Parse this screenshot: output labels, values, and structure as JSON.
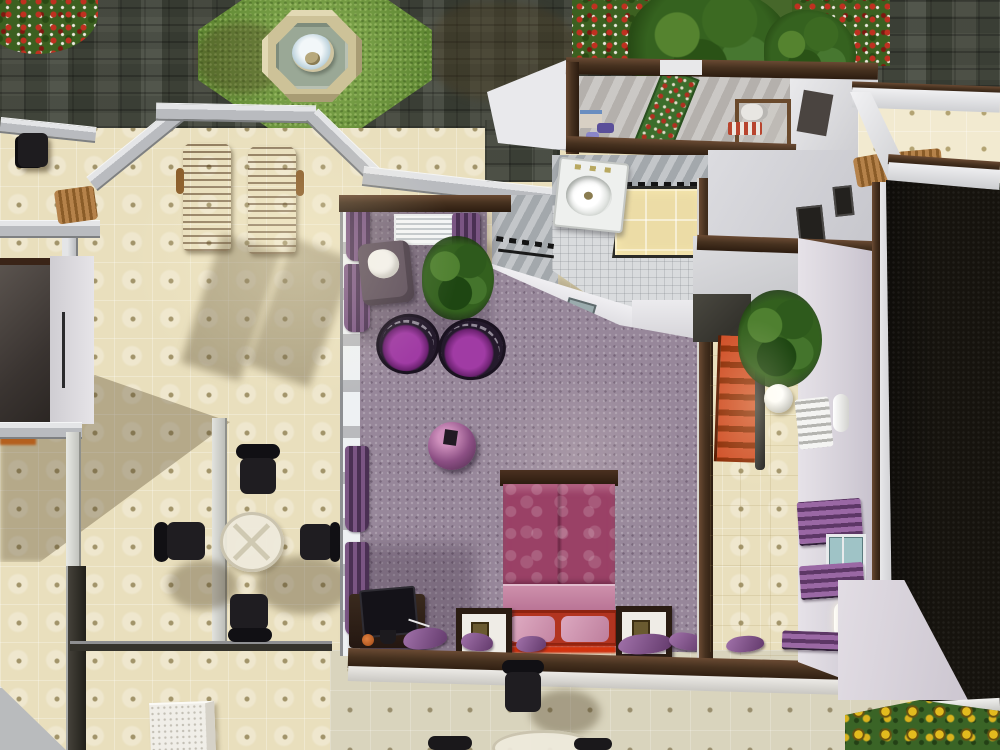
{
  "meta": {
    "domain": "Game",
    "description": "Top-down cutaway view of a residential lot in a life-simulation game. No HUD or text is visible; pure in-world overhead camera of a house interior and courtyard."
  },
  "colors": {
    "tileCream": "#e9dfbd",
    "tileGreyCream": "#d9d4bd",
    "tileDot": "#a2946a",
    "cobble1": "#85887f",
    "grass": "#76a340",
    "fountainStone": "#cdc298",
    "fountainWater": "#9aa896",
    "fountainCenter": "#e7edf0",
    "wallGrey": "#b9bbbf",
    "wallWhite": "#e9e9ec",
    "wallLavender": "#dcd7de",
    "capBrown": "#46311f",
    "carpet": "#97879a",
    "purpleChair": "#8d2f91",
    "curtainPurple": "#6d4c74",
    "bedQuilt": "#9a4166",
    "bedPillow": "#cf92ad",
    "bedFrameRed": "#b23420",
    "woodLounger": "#a87436",
    "plantGreen": "#35621f",
    "bathFloor": "#d9dbdd",
    "bathWall": "#a3a8ac",
    "showerFloor": "#ecdca6",
    "stairRed": "#c1491c",
    "darkRoom": "#16130e",
    "sunGreen": "#3a6426",
    "sunYellow": "#d9b31d",
    "chairBlack": "#1b191c"
  },
  "courtyard": {
    "paving": "grey stone cobble plaza",
    "fountain": "octagonal stone fountain on octagonal grass patch",
    "flowerbed_top_left": "red flower bush bed",
    "tree_bed": "large tree canopy with red climbing flowers along top wall"
  },
  "rooms": [
    {
      "name": "patio-bay",
      "floor": "cream ceramic tile",
      "objects": [
        "wooden lounge chair x2"
      ]
    },
    {
      "name": "upper-balcony",
      "floor": "cream tile",
      "objects": [
        "black chair",
        "wooden bench"
      ]
    },
    {
      "name": "purple-bedroom",
      "floor": "mauve carpet",
      "objects": [
        "double bed with magenta quilt and red frame",
        "nightstand x2",
        "purple papasan chair x2",
        "potted plant",
        "armchair with white throw",
        "purple ball lamp",
        "computer desk with monitor",
        "purple drape curtains",
        "scattered purple cushions"
      ]
    },
    {
      "name": "bathroom",
      "floor": "white mosaic tile",
      "objects": [
        "pedestal sink",
        "toilet",
        "lit shower stall",
        "towel rail"
      ]
    },
    {
      "name": "utility-room",
      "floor": "grey boards",
      "objects": [
        "green floral runner rug",
        "shelf with boxes and bottles",
        "towel roll shelf"
      ]
    },
    {
      "name": "stair-hall",
      "floor": "tan tile",
      "objects": [
        "red staircase going down",
        "dark handrail"
      ]
    },
    {
      "name": "hallway",
      "floor": "tan tile",
      "objects": [
        "potted plant",
        "white sphere sculpture",
        "white radiator",
        "wall sconce x2",
        "purple towel rack x2",
        "small window"
      ]
    },
    {
      "name": "dining-area",
      "floor": "cream tile",
      "objects": [
        "round glass table",
        "black office chair x4",
        "glass partition walls",
        "white dresser"
      ]
    },
    {
      "name": "east-room",
      "floor": "cream tile",
      "objects": [
        "wooden chair x2"
      ]
    },
    {
      "name": "dark-room",
      "floor": "black carpet (unlit)",
      "objects": []
    },
    {
      "name": "lower-room",
      "floor": "grey-cream tile",
      "objects": [
        "black chair",
        "partial glass table with chairs at bottom edge"
      ]
    },
    {
      "name": "left-dark-nook",
      "floor": "dark",
      "objects": [
        "fireplace glow"
      ]
    },
    {
      "name": "sunflower-bed",
      "floor": "garden soil",
      "objects": [
        "sunflower patch"
      ]
    }
  ],
  "lighting": {
    "sun_direction": "from upper-right, long soft shadows toward lower-left",
    "shadows": [
      "lounge chair shadows across patio tile",
      "building shadow across left cream floor",
      "tree shadow on cobbles"
    ]
  }
}
